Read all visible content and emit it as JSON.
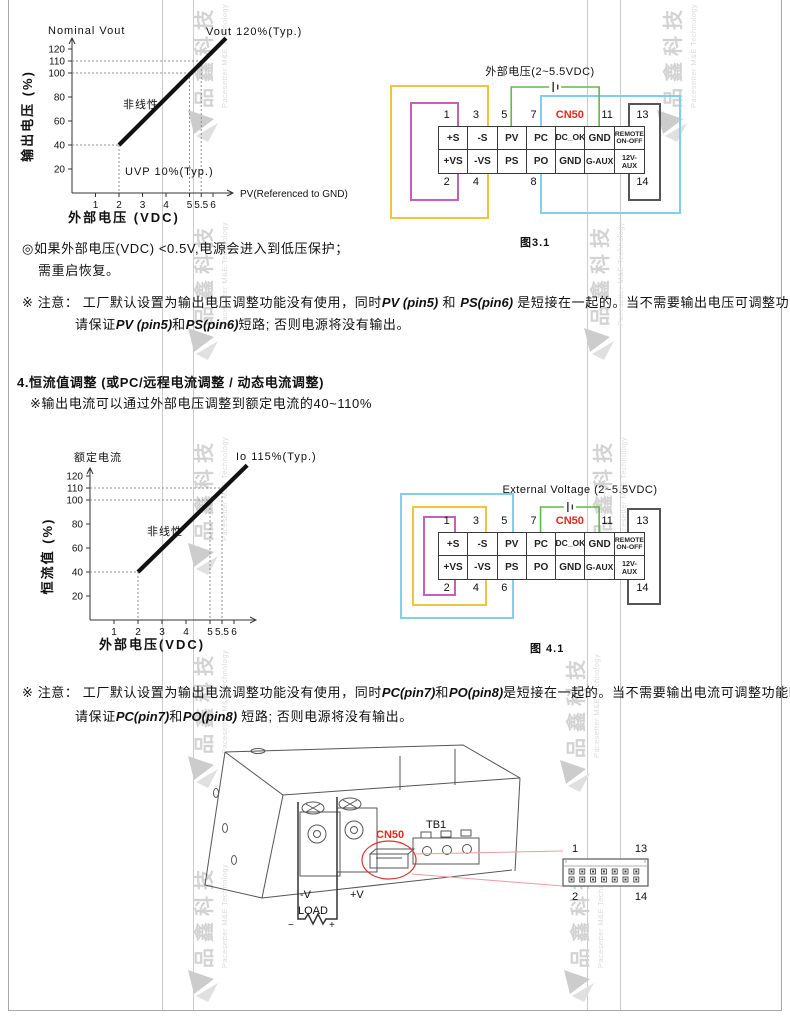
{
  "colors": {
    "yellow": "#f0c43c",
    "magenta": "#c45fc0",
    "cyan": "#7fd0ec",
    "green": "#63b84a",
    "red": "#e8271b",
    "leader_red": "#f09b9b"
  },
  "watermark": {
    "cn": "品鑫科技",
    "en": "Pacesetter M&E Technology"
  },
  "page": {
    "protection_note_line1": "◎如果外部电压(VDC) <0.5V,电源会进入到低压保护；",
    "protection_note_line2": "需重启恢复。",
    "section4_heading": "4.恒流值调整 (或PC/远程电流调整 / 动态电流调整)",
    "section4_subline": "※输出电流可以通过外部电压调整到额定电流的40~110%"
  },
  "notes": {
    "note1_line1": [
      [
        "※ 注意： 工厂默认设置为输出电压调整功能没有使用，同时",
        0
      ],
      [
        "PV (pin5)",
        1
      ],
      [
        " 和 ",
        0
      ],
      [
        "PS(pin6)",
        1
      ],
      [
        " 是短接在一起的。当不需要输出电压可调整功能时，",
        0
      ]
    ],
    "note1_line2": [
      [
        "请保证",
        0
      ],
      [
        "PV (pin5)",
        1
      ],
      [
        "和",
        0
      ],
      [
        "PS(pin6)",
        1
      ],
      [
        "短路; 否则电源将没有输出。",
        0
      ]
    ],
    "note2_line1": [
      [
        "※ 注意： 工厂默认设置为输出电流调整功能没有使用，同时",
        0
      ],
      [
        "PC(pin7)",
        1
      ],
      [
        "和",
        0
      ],
      [
        "PO(pin8)",
        1
      ],
      [
        "是短接在一起的。当不需要输出电流可调整功能时，",
        0
      ]
    ],
    "note2_line2": [
      [
        "请保证",
        0
      ],
      [
        "PC(pin7)",
        1
      ],
      [
        "和",
        0
      ],
      [
        "PO(pin8)",
        1
      ],
      [
        " 短路; 否则电源将没有输出。",
        0
      ]
    ]
  },
  "chart_data": [
    {
      "type": "line",
      "title": "Nominal Vout",
      "xlabel": "外部电压 (VDC)",
      "ylabel": "输出电压 (%)",
      "x_axis_label": "PV(Referenced to GND)",
      "x_ticks": [
        "1",
        "2",
        "3",
        "4",
        "5",
        "5.5",
        "6"
      ],
      "x_tick_values": [
        1,
        2,
        3,
        4,
        5,
        5.5,
        6
      ],
      "y_ticks": [
        "20",
        "40",
        "60",
        "80",
        "100",
        "110",
        "120"
      ],
      "y_tick_values": [
        20,
        40,
        60,
        80,
        100,
        110,
        120
      ],
      "xlim": [
        0,
        6.8
      ],
      "ylim": [
        0,
        135
      ],
      "grid": false,
      "line": [
        [
          2,
          40
        ],
        [
          6.55,
          129
        ]
      ],
      "guides": [
        [
          2,
          40
        ],
        [
          5,
          100
        ],
        [
          5.5,
          110
        ]
      ],
      "annotations": [
        {
          "text": "Vout 120%(Typ.)"
        },
        {
          "text": "非线性"
        },
        {
          "text": "UVP 10%(Typ.)"
        }
      ]
    },
    {
      "type": "line",
      "title": "额定电流",
      "xlabel": "外部电压(VDC)",
      "ylabel": "恒流值 (%)",
      "x_axis_label": "",
      "x_ticks": [
        "1",
        "2",
        "3",
        "4",
        "5",
        "5.5",
        "6"
      ],
      "x_tick_values": [
        1,
        2,
        3,
        4,
        5,
        5.5,
        6
      ],
      "y_ticks": [
        "20",
        "40",
        "60",
        "80",
        "100",
        "110",
        "120"
      ],
      "y_tick_values": [
        20,
        40,
        60,
        80,
        100,
        110,
        120
      ],
      "xlim": [
        0,
        6.8
      ],
      "ylim": [
        0,
        135
      ],
      "grid": false,
      "line": [
        [
          2,
          40
        ],
        [
          6.55,
          129
        ]
      ],
      "guides": [
        [
          2,
          40
        ],
        [
          5,
          100
        ],
        [
          5.5,
          110
        ]
      ],
      "annotations": [
        {
          "text": "Io 115%(Typ.)"
        },
        {
          "text": "非线性"
        }
      ]
    }
  ],
  "figures": {
    "fig31": {
      "caption": "图3.1",
      "ext_label": "外部电压(2~5.5VDC)",
      "cn_label": "CN50",
      "row1": [
        "+S",
        "-S",
        "PV",
        "PC",
        "DC_OK",
        "GND",
        "REMOTE\nON-OFF"
      ],
      "row2": [
        "+VS",
        "-VS",
        "PS",
        "PO",
        "GND",
        "G-AUX",
        "12V-AUX"
      ],
      "pins_top": [
        [
          "1",
          0,
          -6
        ],
        [
          "3",
          1,
          -6
        ],
        [
          "5",
          2,
          -7
        ],
        [
          "7",
          3,
          -7
        ],
        [
          "11",
          5,
          8
        ],
        [
          "13",
          6,
          14
        ]
      ],
      "pins_bottom": [
        [
          "2",
          0,
          -6
        ],
        [
          "4",
          1,
          -6
        ],
        [
          "8",
          3,
          -7
        ],
        [
          "14",
          6,
          14
        ]
      ]
    },
    "fig41": {
      "caption": "图 4.1",
      "ext_label": "External Voltage (2~5.5VDC)",
      "cn_label": "CN50",
      "row1": [
        "+S",
        "-S",
        "PV",
        "PC",
        "DC_OK",
        "GND",
        "REMOTE\nON-OFF"
      ],
      "row2": [
        "+VS",
        "-VS",
        "PS",
        "PO",
        "GND",
        "G-AUX",
        "12V-AUX"
      ],
      "pins_top": [
        [
          "1",
          0,
          -6
        ],
        [
          "3",
          1,
          -6
        ],
        [
          "5",
          2,
          -7
        ],
        [
          "7",
          3,
          -7
        ],
        [
          "11",
          5,
          8
        ],
        [
          "13",
          6,
          14
        ]
      ],
      "pins_bottom": [
        [
          "2",
          0,
          -6
        ],
        [
          "4",
          1,
          -6
        ],
        [
          "6",
          2,
          -7
        ],
        [
          "14",
          6,
          14
        ]
      ]
    }
  },
  "bottom_figure": {
    "cn50": "CN50",
    "tb1": "TB1",
    "neg_v": "-V",
    "pos_v": "+V",
    "load": "LOAD",
    "minus": "−",
    "plus": "+",
    "pin1": "1",
    "pin13": "13",
    "pin2": "2",
    "pin14": "14"
  }
}
